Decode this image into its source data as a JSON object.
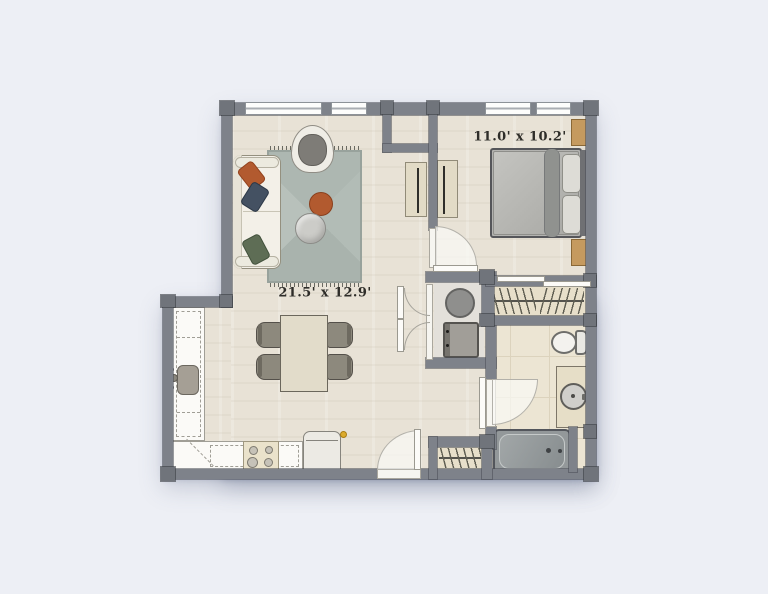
{
  "page": {
    "type": "apartment-floor-plan"
  },
  "labels": {
    "living_dining": "21.5' x 12.9'",
    "bedroom": "11.0' x 10.2'"
  },
  "colors": {
    "background": "#edeff5",
    "wall": "#7e828a",
    "floor_wood": "#e8e2d6",
    "bathroom_tile": "#ece5d3",
    "closet_floor": "#e7dfca",
    "rug": "#b2bcb6",
    "accent_orange": "#b25a2f",
    "pillow_navy": "#445162",
    "pillow_green": "#5e6d55",
    "nightstand_tan": "#c59a5f",
    "fridge_handle_dot": "#dcab2d"
  },
  "fixtures": [
    "sofa",
    "armchair",
    "coffee-table",
    "ottoman",
    "rug",
    "dining-table",
    "dining-chair",
    "kitchen-counter",
    "kitchen-sink",
    "stove",
    "refrigerator",
    "washer",
    "dryer",
    "bed",
    "nightstand",
    "wardrobe-panel",
    "toilet",
    "vanity-sink",
    "bathtub",
    "closet-hangers",
    "entry-door",
    "bedroom-door",
    "bathroom-door",
    "laundry-double-doors",
    "window"
  ]
}
